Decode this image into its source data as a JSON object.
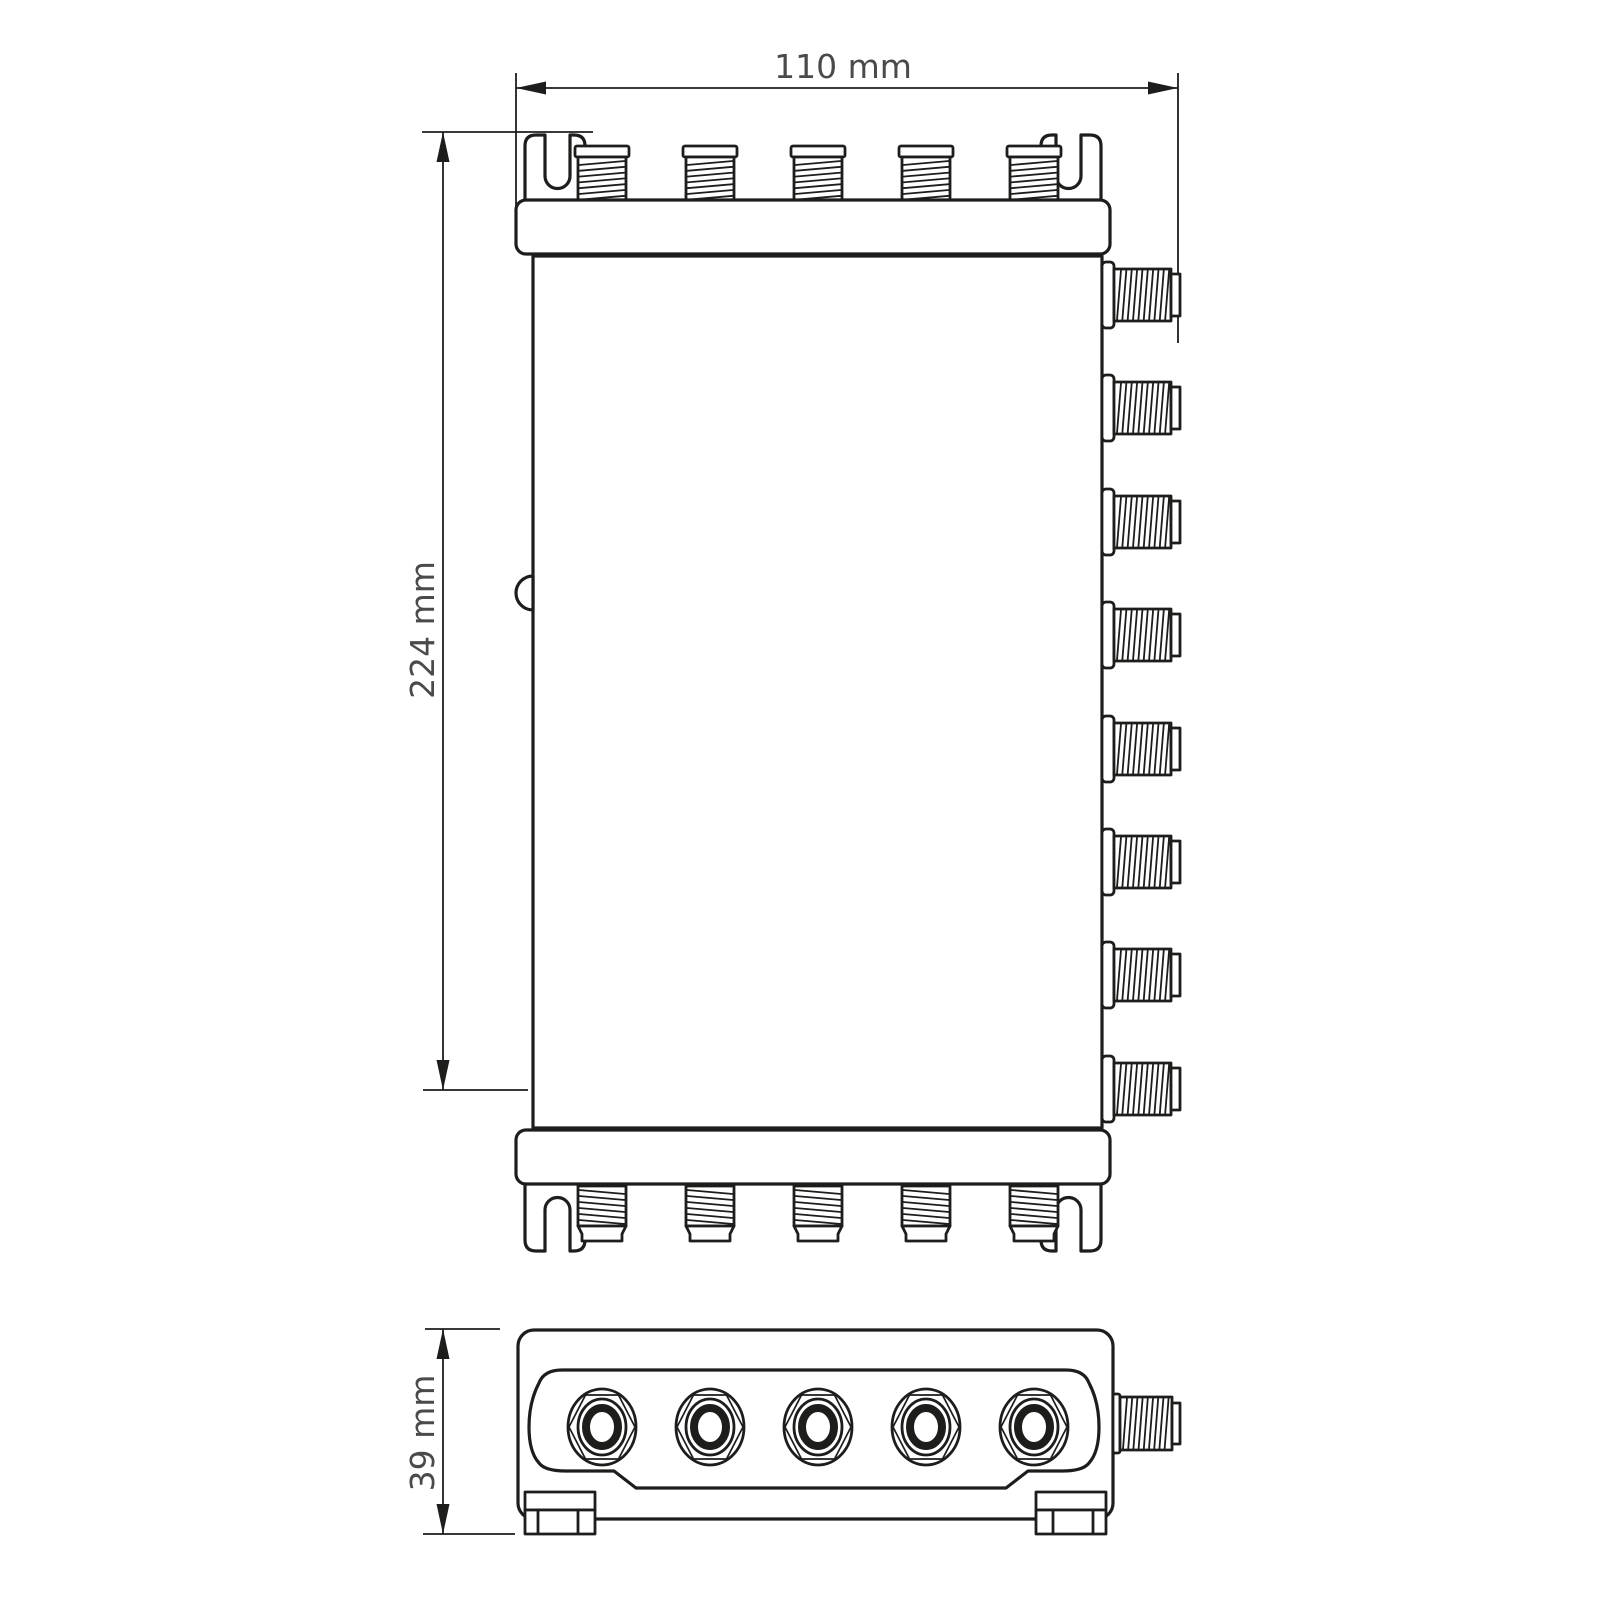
{
  "drawing": {
    "type": "technical dimension drawing",
    "subject": "multiswitch housing with F-connectors, two orthographic views",
    "background": "#ffffff",
    "line_color": "#1d1d1b",
    "text_color": "#4a4a49",
    "views": {
      "front_view": {
        "name": "front view",
        "width_dimension": "110 mm",
        "height_dimension": "224 mm",
        "top_connector_count": 5,
        "bottom_connector_count": 5,
        "side_connector_count": 8
      },
      "end_view": {
        "name": "bottom end view",
        "depth_dimension": "39 mm",
        "connector_count": 5,
        "side_connector_count": 1
      }
    }
  }
}
